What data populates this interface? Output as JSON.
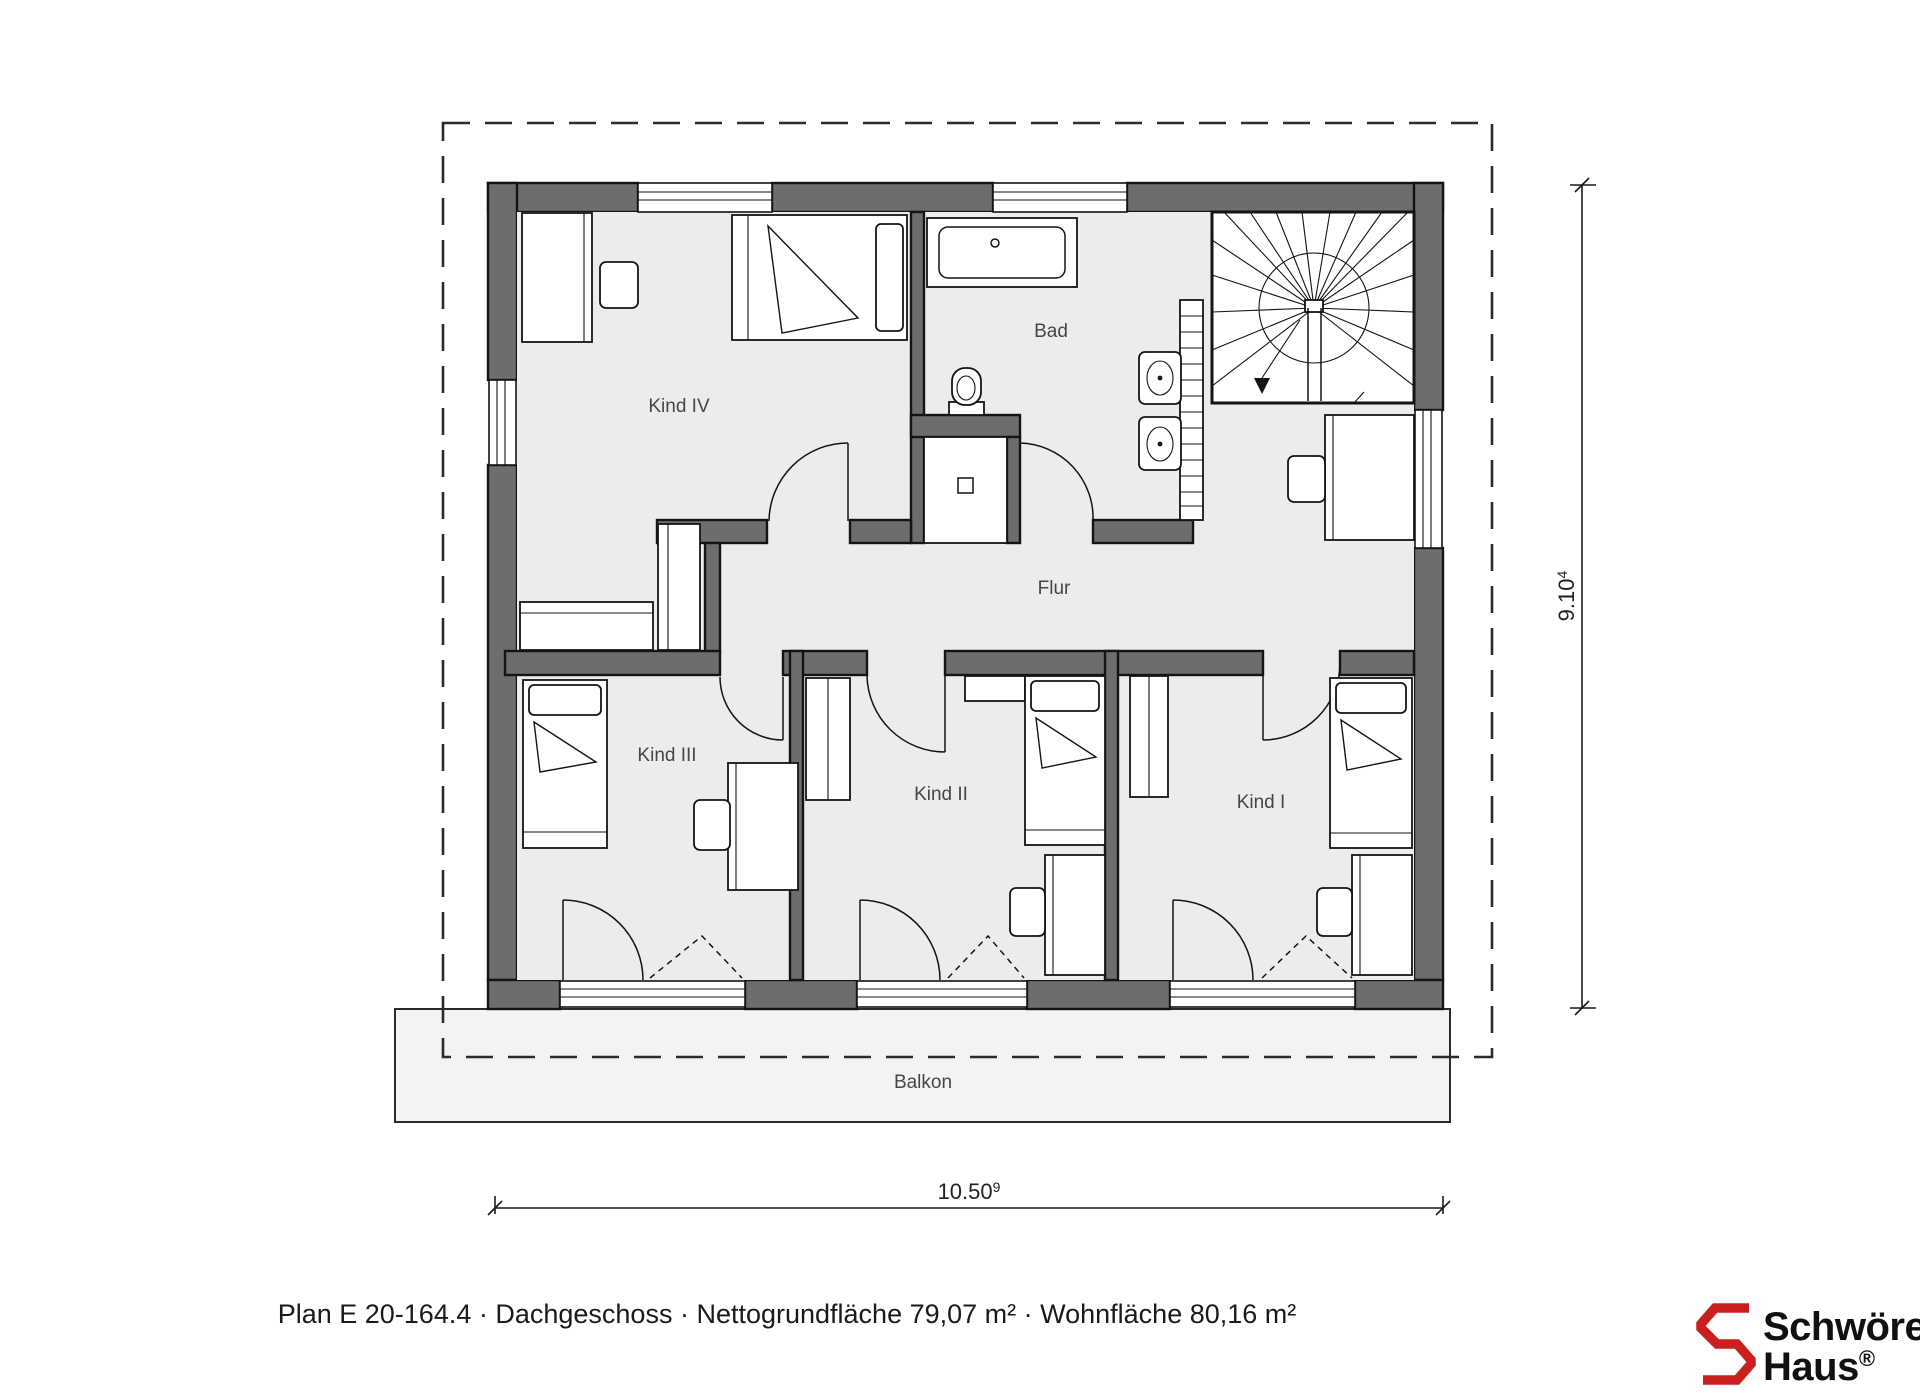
{
  "labels": {
    "kind_iv": "Kind IV",
    "bad": "Bad",
    "flur": "Flur",
    "kind_iii": "Kind III",
    "kind_ii": "Kind II",
    "kind_i": "Kind I",
    "balkon": "Balkon"
  },
  "dimensions": {
    "width": {
      "value": "10.50",
      "sup": "9"
    },
    "height": {
      "value": "9.10",
      "sup": "4"
    }
  },
  "caption": {
    "text": "Plan E 20-164.4 · Dachgeschoss · Nettogrundfläche 79,07 m² · Wohnfläche 80,16 m²"
  },
  "logo": {
    "line1": "Schwörer",
    "line2": "Haus",
    "reg": "®"
  },
  "colors": {
    "wall": "#6d6d6d",
    "floor": "#ececec",
    "balcony": "#f3f3f2",
    "label": "#45454f",
    "text": "#1a1a1a",
    "accent_red": "#c9201f"
  }
}
